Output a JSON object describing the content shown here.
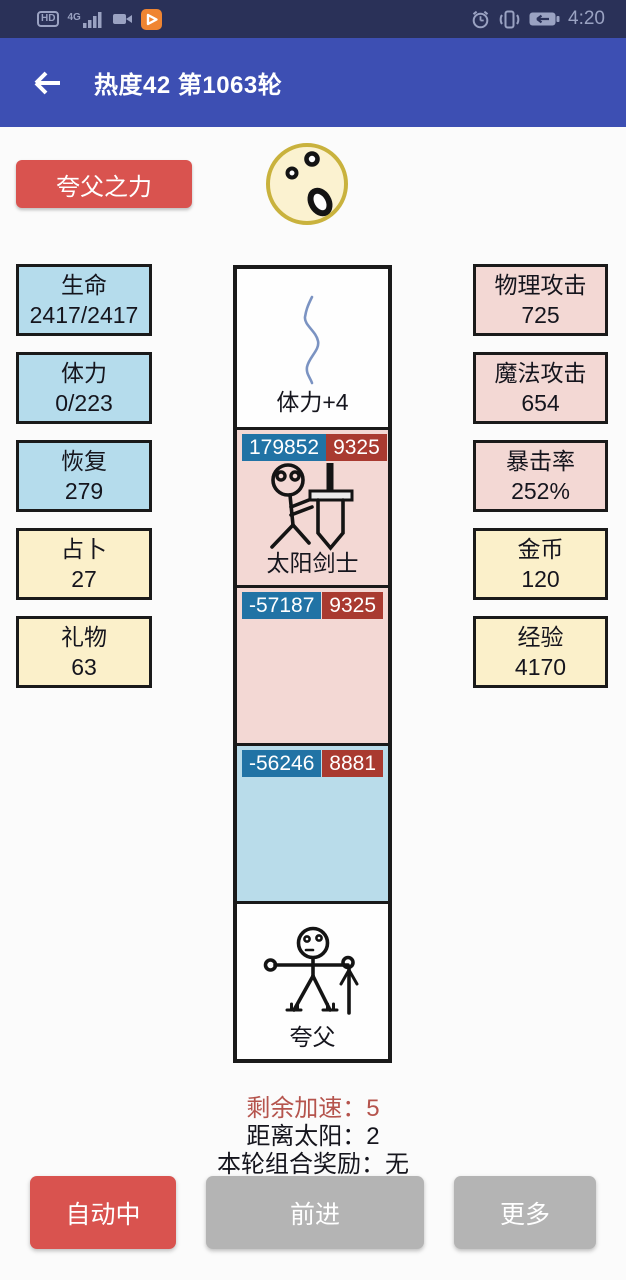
{
  "status_bar": {
    "hd": "HD",
    "network": "4G",
    "time": "4:20",
    "left_icons": [
      "hd-icon",
      "signal-icon",
      "camcorder-icon",
      "video-app-icon"
    ],
    "right_icons": [
      "alarm-icon",
      "vibrate-icon",
      "battery-icon"
    ]
  },
  "header": {
    "title": "热度42 第1063轮"
  },
  "skill_button": {
    "label": "夸父之力"
  },
  "stats_left": [
    {
      "label": "生命",
      "value": "2417/2417"
    },
    {
      "label": "体力",
      "value": "0/223"
    },
    {
      "label": "恢复",
      "value": "279"
    },
    {
      "label": "占卜",
      "value": "27"
    },
    {
      "label": "礼物",
      "value": "63"
    }
  ],
  "stats_right": [
    {
      "label": "物理攻击",
      "value": "725"
    },
    {
      "label": "魔法攻击",
      "value": "654"
    },
    {
      "label": "暴击率",
      "value": "252%"
    },
    {
      "label": "金币",
      "value": "120"
    },
    {
      "label": "经验",
      "value": "4170"
    }
  ],
  "track": {
    "cells": [
      {
        "type": "event",
        "label": "体力+4"
      },
      {
        "type": "enemy",
        "hp": "179852",
        "atk": "9325",
        "label": "太阳剑士"
      },
      {
        "type": "empty-pink",
        "hp": "-57187",
        "atk": "9325"
      },
      {
        "type": "empty-blue",
        "hp": "-56246",
        "atk": "8881"
      },
      {
        "type": "player",
        "label": "夸父"
      }
    ]
  },
  "info": {
    "line1": "剩余加速：5",
    "line2": "距离太阳：2",
    "line3": "本轮组合奖励：无"
  },
  "footer_buttons": [
    {
      "label": "自动中"
    },
    {
      "label": "前进"
    },
    {
      "label": "更多"
    }
  ],
  "colors": {
    "status_bar": "#2a3158",
    "app_bar": "#3d4fb3",
    "accent_red": "#d9534f",
    "button_gray": "#b4b4b4",
    "stat_blue": "#b5dcec",
    "stat_yellow": "#fbf0ca",
    "stat_pink": "#f3d8d4",
    "cell_blue": "#b9dcea",
    "badge_blue": "#2173a5",
    "badge_red": "#a93a30",
    "info_red": "#b5544d",
    "sun_border": "#c9b23d",
    "sun_fill": "#fbf2d0"
  }
}
